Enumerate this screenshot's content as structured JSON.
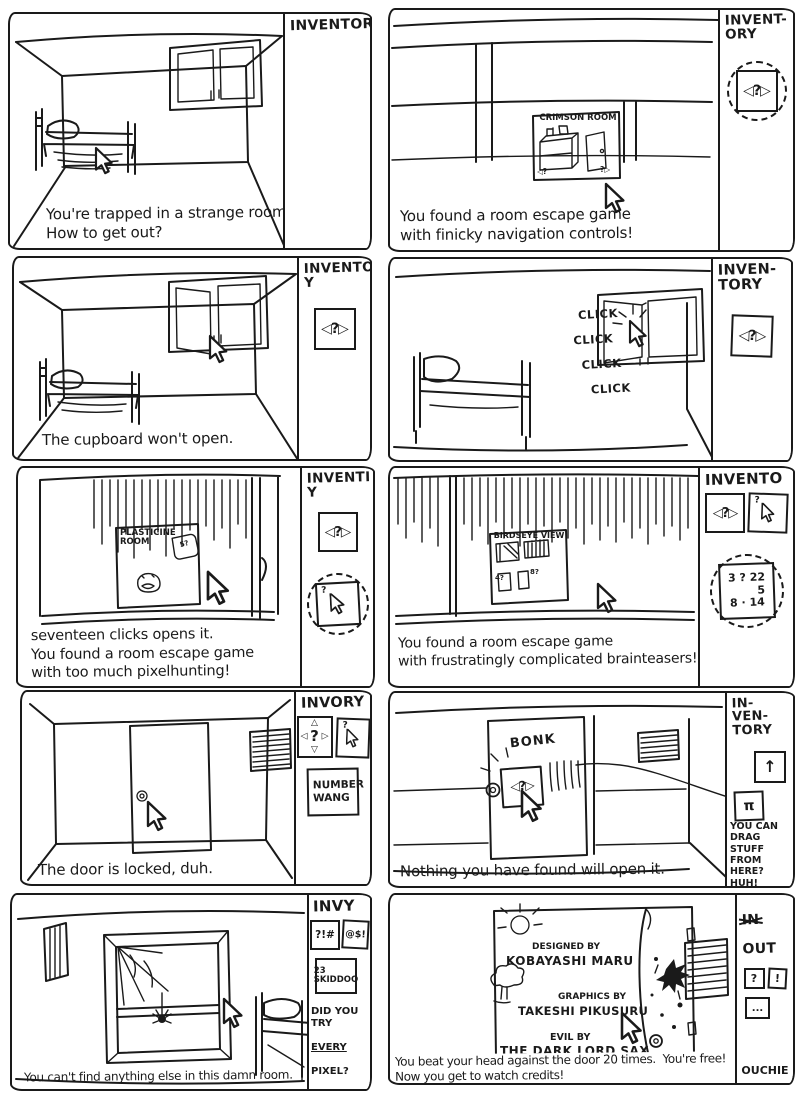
{
  "ink": "#1a1a1a",
  "paper": "#ffffff",
  "panels": [
    {
      "caption": "You're trapped in a strange room.\nHow to get out?",
      "inventory": {
        "title": "INVENTORY",
        "items": []
      }
    },
    {
      "caption": "You found a room escape game\nwith finicky navigation controls!",
      "scene": {
        "screen_title": "CRIMSON ROOM",
        "nav_left": "◁?",
        "nav_right": "?▷"
      },
      "inventory": {
        "title": "INVENT-\nORY",
        "items": [
          {
            "label": "◁?▷"
          }
        ]
      }
    },
    {
      "caption": "The cupboard won't open.",
      "inventory": {
        "title": "INVENTOR\nY",
        "items": [
          {
            "label": "◁?▷"
          }
        ]
      }
    },
    {
      "caption": "",
      "scene": {
        "clicks": [
          "CLICK",
          "CLICK",
          "CLICK",
          "CLICK"
        ]
      },
      "inventory": {
        "title": "INVEN-\nTORY",
        "items": [
          {
            "label": "◁?▷"
          }
        ]
      }
    },
    {
      "caption": "seventeen clicks opens it.\nYou found a room escape game\nwith too much pixelhunting!",
      "scene": {
        "screen_title": "PLASTICINE\nROOM",
        "card_label": "5?"
      },
      "inventory": {
        "title": "INVENTI\nY",
        "items": [
          {
            "label": "◁?▷"
          },
          {
            "label": "?"
          }
        ]
      }
    },
    {
      "caption": "You found a room escape game\nwith frustratingly complicated brainteasers!",
      "scene": {
        "screen_title": "BIRDSEYE VIEW",
        "mark_left": "4?",
        "mark_right": "8?"
      },
      "inventory": {
        "title": "INVENTO",
        "items": [
          {
            "label": "◁?▷"
          },
          {
            "label": "?"
          },
          {
            "numbers": [
              "3 ? 22",
              "5",
              "8 · 14"
            ]
          }
        ]
      }
    },
    {
      "caption": "The door is locked, duh.",
      "inventory": {
        "title": "INVORY",
        "items": [
          {
            "nav4": {
              "top": "△",
              "left": "◁",
              "center": "?",
              "right": "▷",
              "bottom": "▽"
            }
          },
          {
            "label": "?"
          }
        ],
        "note": "NUMBER\nWANG"
      }
    },
    {
      "caption": "Nothing you have found will open it.",
      "scene": {
        "bonk": "BONK",
        "dragged_item": "◁?▷"
      },
      "inventory": {
        "title": "IN-\nVEN-\nTORY",
        "items": [
          {
            "label": "↑"
          },
          {
            "label": "π"
          }
        ],
        "note": "YOU CAN\nDRAG STUFF\nFROM HERE?\nHUH!"
      }
    },
    {
      "caption": "You can't find anything else in this damn room.",
      "inventory": {
        "title": "INVY",
        "items": [
          {
            "label": "?!#"
          },
          {
            "label": "@$!"
          },
          {
            "label": "23\nSKIDDOO"
          }
        ],
        "note_lines": [
          "DID YOU TRY",
          "EVERY",
          "PIXEL?"
        ]
      }
    },
    {
      "caption": "You beat your head against the door 20 times.  You're free!\nNow you get to watch credits!",
      "scene": {
        "credits": [
          "DESIGNED BY",
          "KOBAYASHI MARU",
          "GRAPHICS BY",
          "TAKESHI PIKUSURU",
          "EVIL BY",
          "THE DARK LORD SAX"
        ]
      },
      "inventory": {
        "title_in": "IN",
        "title_out": "OUT",
        "items": [
          {
            "label": "?"
          },
          {
            "label": "!"
          },
          {
            "label": "..."
          }
        ],
        "footer": "OUCHIE"
      }
    }
  ]
}
